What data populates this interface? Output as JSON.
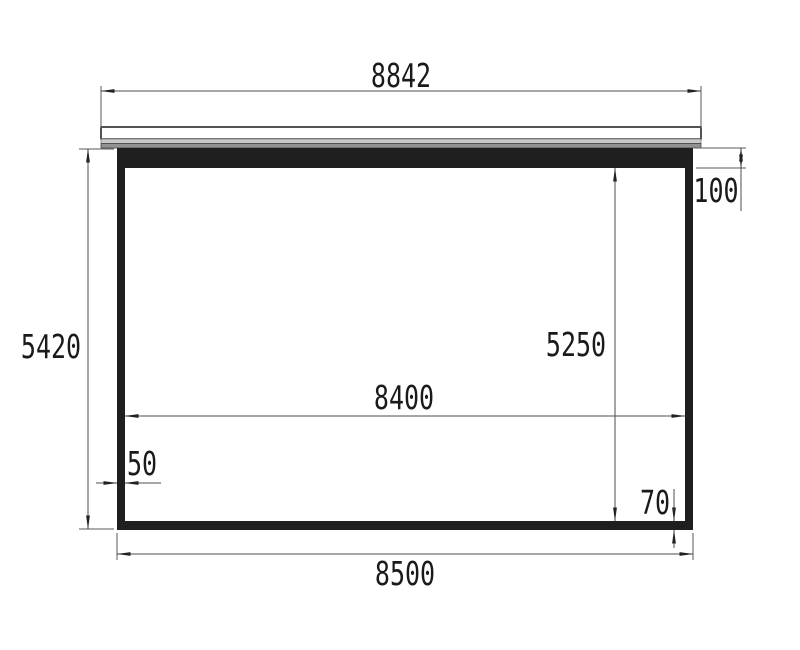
{
  "drawing": {
    "type": "technical-dimension-drawing",
    "subject": "projection-screen-front-view"
  },
  "dimensions": {
    "case_width": "8842",
    "outer_height": "5420",
    "top_border": "100",
    "viewing_height": "5250",
    "viewing_width": "8400",
    "side_border": "50",
    "bottom_border": "70",
    "outer_width": "8500"
  },
  "colors": {
    "frame_fill": "#1f1f1f",
    "case_light_strip": "#c8c8c8",
    "case_dark_strip": "#929292",
    "dimension_line": "#4d4d4d",
    "arrow": "#222222",
    "text": "#1a1a1a",
    "background": "#ffffff"
  }
}
